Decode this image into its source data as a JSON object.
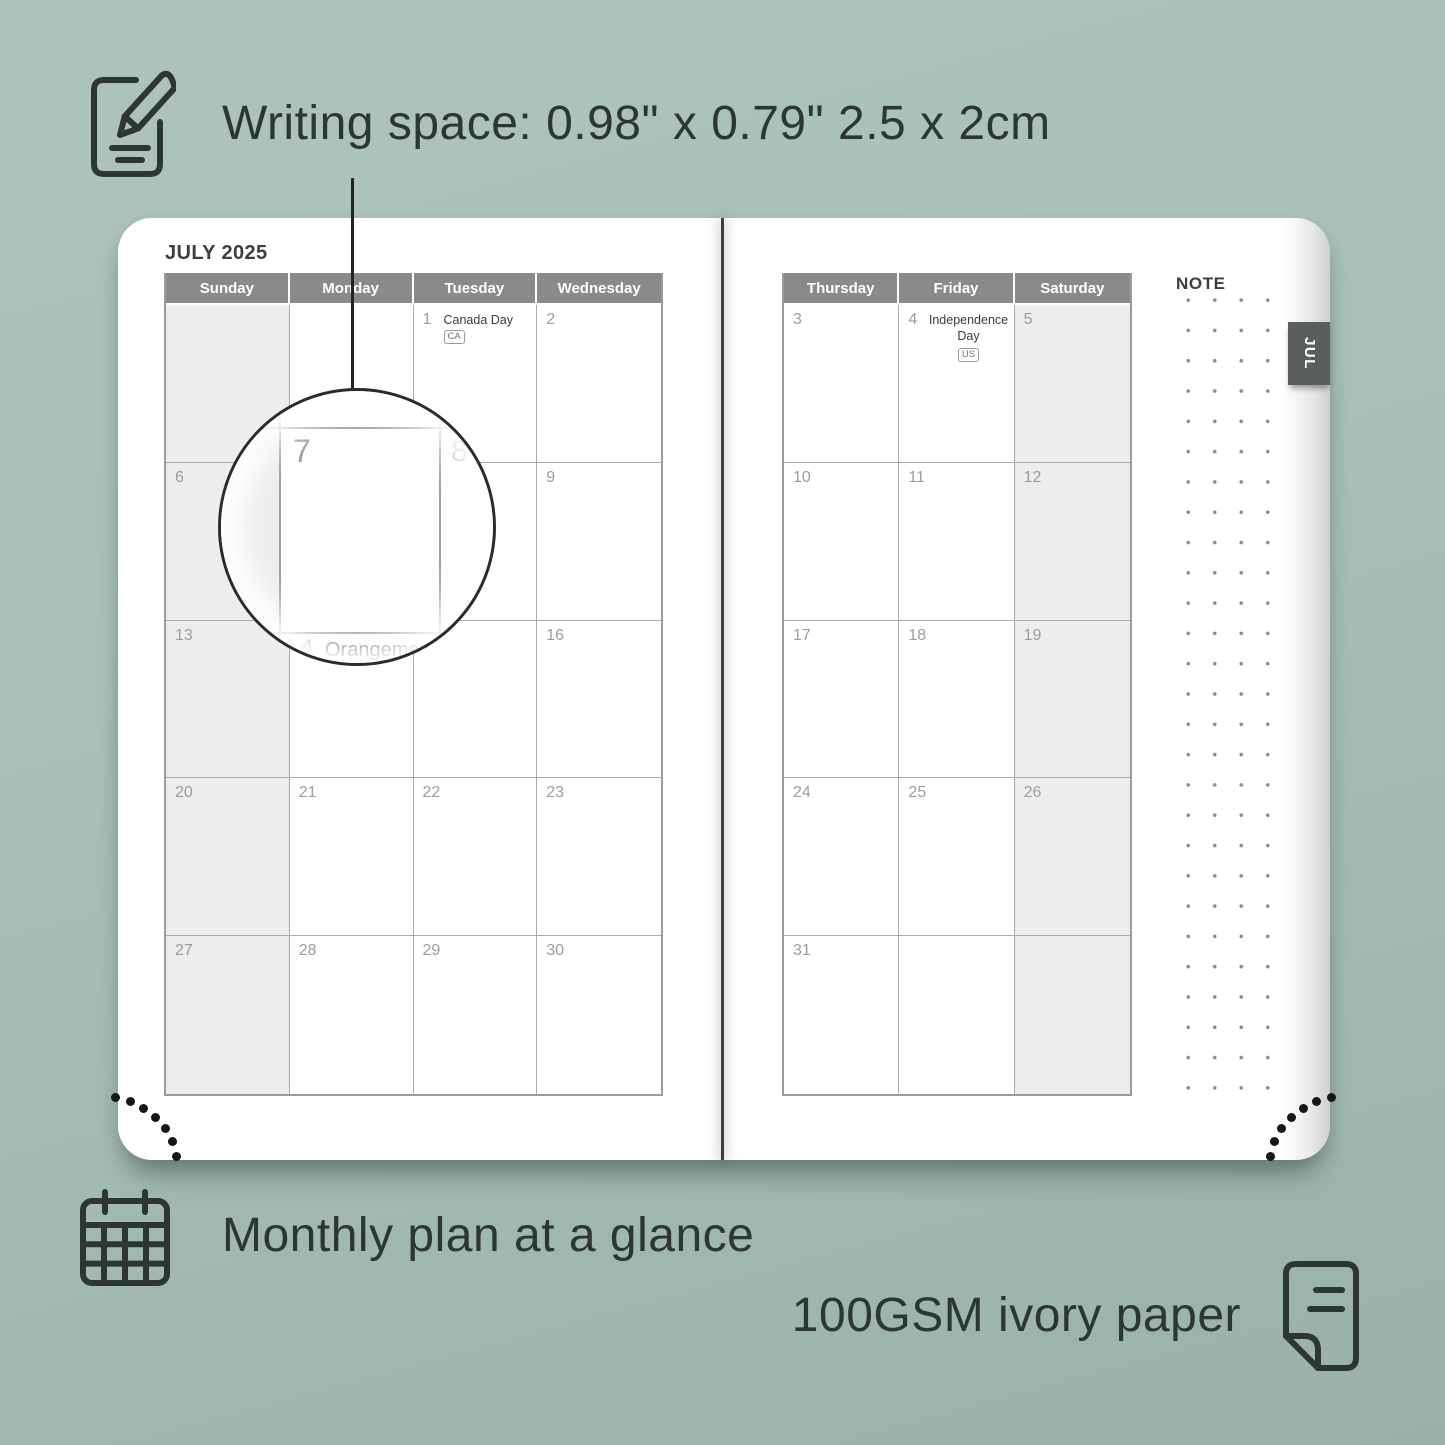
{
  "colors": {
    "background": "#a9c0b8",
    "ink": "#2c3733",
    "header_bg": "#8a8a8a",
    "shaded_cell": "#ededed",
    "tab_bg": "#5b5f5c",
    "grid_line": "#ababab",
    "day_number": "#9c9c9c"
  },
  "annotations": {
    "writing_space": "Writing space: 0.98\" x 0.79\" 2.5 x 2cm",
    "monthly_plan": "Monthly plan at a glance",
    "paper": "100GSM ivory paper"
  },
  "icons": {
    "note": "pencil-note-icon",
    "calendar": "calendar-grid-icon",
    "paper": "paper-sheet-icon"
  },
  "planner": {
    "title": "JULY 2025",
    "tab_label": "JUL",
    "note_label": "NOTE",
    "left_headers": [
      "Sunday",
      "Monday",
      "Tuesday",
      "Wednesday"
    ],
    "right_headers": [
      "Thursday",
      "Friday",
      "Saturday"
    ],
    "left_shaded_column": 0,
    "right_shaded_column": 2,
    "left_rows": [
      [
        {
          "day": ""
        },
        {
          "day": ""
        },
        {
          "day": "1",
          "holiday": "Canada Day",
          "badge": "CA",
          "badge_inline": true
        },
        {
          "day": "2"
        }
      ],
      [
        {
          "day": "6"
        },
        {
          "day": "7"
        },
        {
          "day": "8"
        },
        {
          "day": "9"
        }
      ],
      [
        {
          "day": "13"
        },
        {
          "day": "14",
          "holiday": "Orangemen's Day"
        },
        {
          "day": "15"
        },
        {
          "day": "16"
        }
      ],
      [
        {
          "day": "20"
        },
        {
          "day": "21"
        },
        {
          "day": "22"
        },
        {
          "day": "23"
        }
      ],
      [
        {
          "day": "27"
        },
        {
          "day": "28"
        },
        {
          "day": "29"
        },
        {
          "day": "30"
        }
      ]
    ],
    "right_rows": [
      [
        {
          "day": "3"
        },
        {
          "day": "4",
          "holiday": "Independence Day",
          "badge": "US",
          "badge_inline": false
        },
        {
          "day": "5"
        }
      ],
      [
        {
          "day": "10"
        },
        {
          "day": "11"
        },
        {
          "day": "12"
        }
      ],
      [
        {
          "day": "17"
        },
        {
          "day": "18"
        },
        {
          "day": "19"
        }
      ],
      [
        {
          "day": "24"
        },
        {
          "day": "25"
        },
        {
          "day": "26"
        }
      ],
      [
        {
          "day": "31"
        },
        {
          "day": ""
        },
        {
          "day": ""
        }
      ]
    ]
  },
  "magnifier": {
    "label_day": "7",
    "label_next_day": "8",
    "bottom_day": "14",
    "bottom_holiday": "Orangemen's D"
  }
}
